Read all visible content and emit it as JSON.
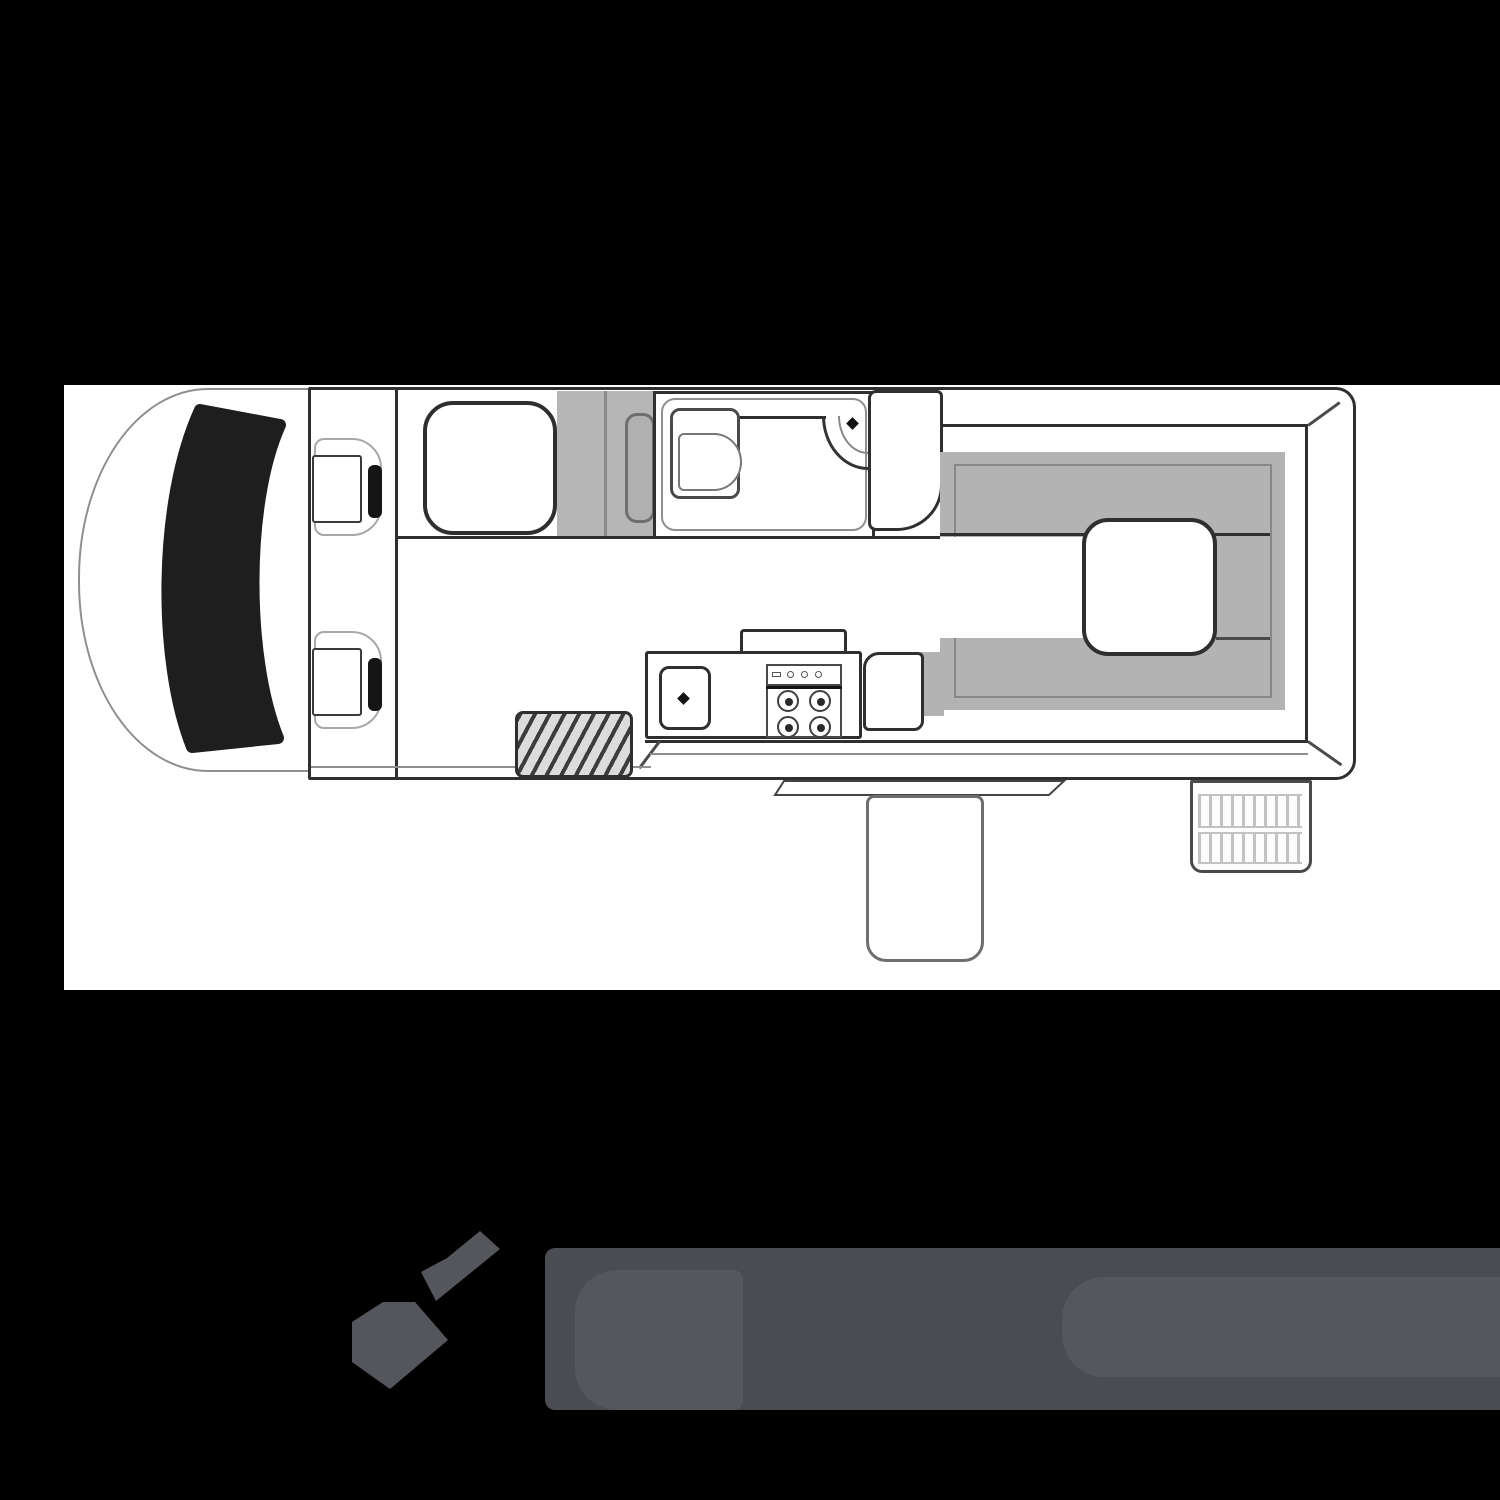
{
  "meta": {
    "kind": "campervan-floorplan-diagram",
    "orientation": "side-profile-top-view, cab at left, rear at right",
    "visible_text": ""
  },
  "colors": {
    "page_bg": "#000000",
    "canvas_bg": "#ffffff",
    "outline_dark": "#2f2f2f",
    "outline_mid": "#4a4a4a",
    "outline_light": "#8f8f8f",
    "cushion_gray": "#b3b3b3",
    "wardrobe_gray": "#b6b6b6",
    "panel_gray": "#b0b0b0",
    "windshield_black": "#1e1e1e",
    "headrest_black": "#151515",
    "hatch_bg": "#dcdcdc",
    "hatch_line": "#3c3c3c",
    "grille_stripe": "#c2c2c2",
    "logo_dark": "#4a4c51",
    "logo_mid": "#54565b",
    "logo_light": "#55575c"
  },
  "floorplan": {
    "components": [
      "cab",
      "windshield",
      "passenger-seat",
      "driver-seat",
      "front-cabinet",
      "wardrobe-unit",
      "bathroom",
      "toilet",
      "corner-basin",
      "rear-wardrobe",
      "rear-lounge-cushions",
      "rear-table",
      "kitchen-counter",
      "sink",
      "stove-four-burner",
      "kitchen-bench-end",
      "entry-step-hatched",
      "sliding-door-track",
      "exterior-step",
      "rear-vent-step"
    ]
  },
  "logo": {
    "mark": "two-kite-star-emblem",
    "wordmark": "unreadable-silhouette-band"
  }
}
